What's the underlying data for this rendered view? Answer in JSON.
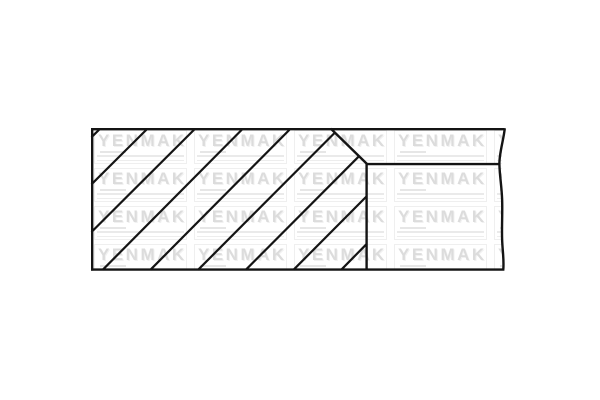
{
  "page": {
    "background_color": "#ffffff"
  },
  "diagram": {
    "name": "piston-ring-cross-section",
    "description": "Technical cross-section drawing of a piston ring with diagonal section hatching, a chamfered top-right corner, a horizontal groove line, and a wavy break line on the right edge",
    "line_color": "#141414",
    "hatch_line_count": 9
  },
  "watermark": {
    "text": "YENMAK",
    "color": "#dcdcdc",
    "rows": 4,
    "cols": 5
  }
}
